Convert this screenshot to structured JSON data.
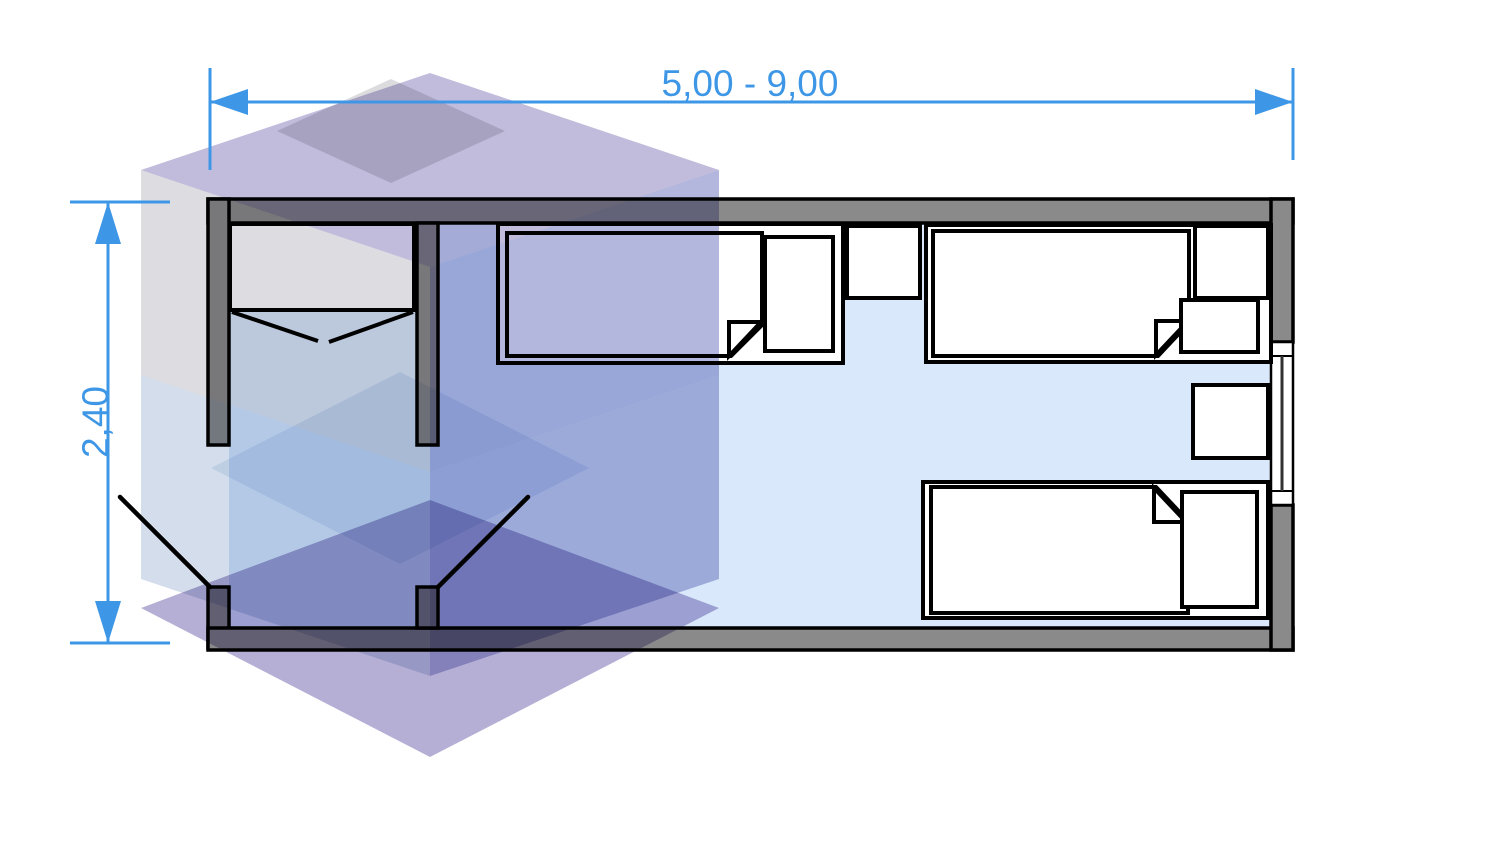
{
  "drawing": {
    "type": "floor-plan",
    "dimensions": {
      "width_label": "5,00 - 9,00",
      "height_label": "2,40",
      "color": "#3e97e6"
    },
    "plan": {
      "wall_color": "#8a8a8a",
      "floor_color": "#d9e8fa",
      "outline_color": "#000000",
      "furniture_fill": "#ffffff",
      "counts": {
        "beds": 3,
        "pillows": 3,
        "nightstands": 2,
        "wardrobes": 1,
        "door_leaves": 2,
        "windows": 1
      }
    },
    "watermark": {
      "name": "isometric-stacked-cubes-logo",
      "colors": {
        "top_purple": "#c1bcdc",
        "top_gray": "#dcdcdf",
        "left_gray": "#dddce1",
        "right_blue_purple": "#b4b7dd",
        "mid_light_blue": "#e5eef7",
        "lower_left_blue": "#d4ddeb",
        "lower_right_purple": "#b7bbdf",
        "bottom_purple": "#b6afd5"
      }
    }
  }
}
